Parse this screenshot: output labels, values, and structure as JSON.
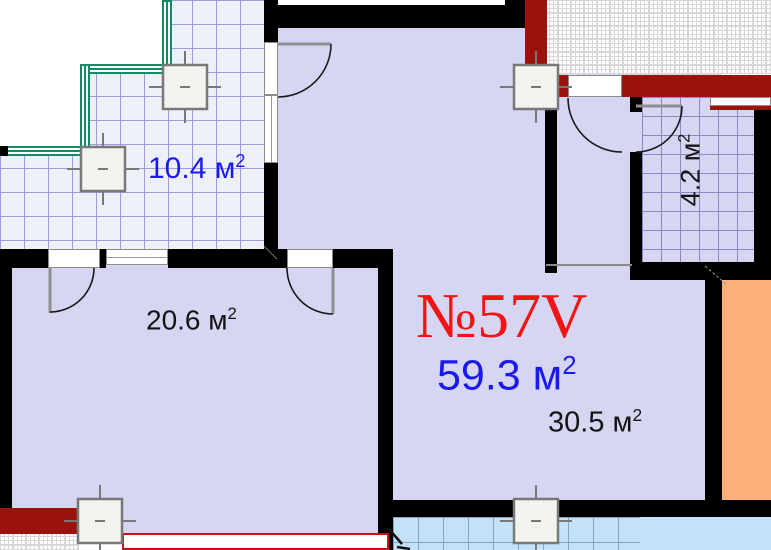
{
  "plan": {
    "apartment_number": "№57V",
    "areas": {
      "balcony": {
        "text": "10.4 м",
        "sup": "2"
      },
      "living": {
        "text": "20.6 м",
        "sup": "2"
      },
      "total": {
        "text": "59.3 м",
        "sup": "2"
      },
      "main": {
        "text": "30.5 м",
        "sup": "2"
      },
      "bathroom": {
        "text": "4.2 м",
        "sup": "2"
      }
    },
    "colors": {
      "room_fill": "#d6d6f3",
      "balcony_tile_fill": "#eef0f8",
      "balcony_grid_line": "#9c9cdb",
      "lower_balcony_blue": "#c3e2fa",
      "structural_red_wall": "#9c130d",
      "window_frame_red": "#c81111",
      "glazing_green": "#168a66",
      "neighbor_unit_orange": "#fcb07a",
      "area_text_blue": "#1a1af0",
      "number_text_red": "#f01414",
      "wall_black": "#000000"
    }
  }
}
